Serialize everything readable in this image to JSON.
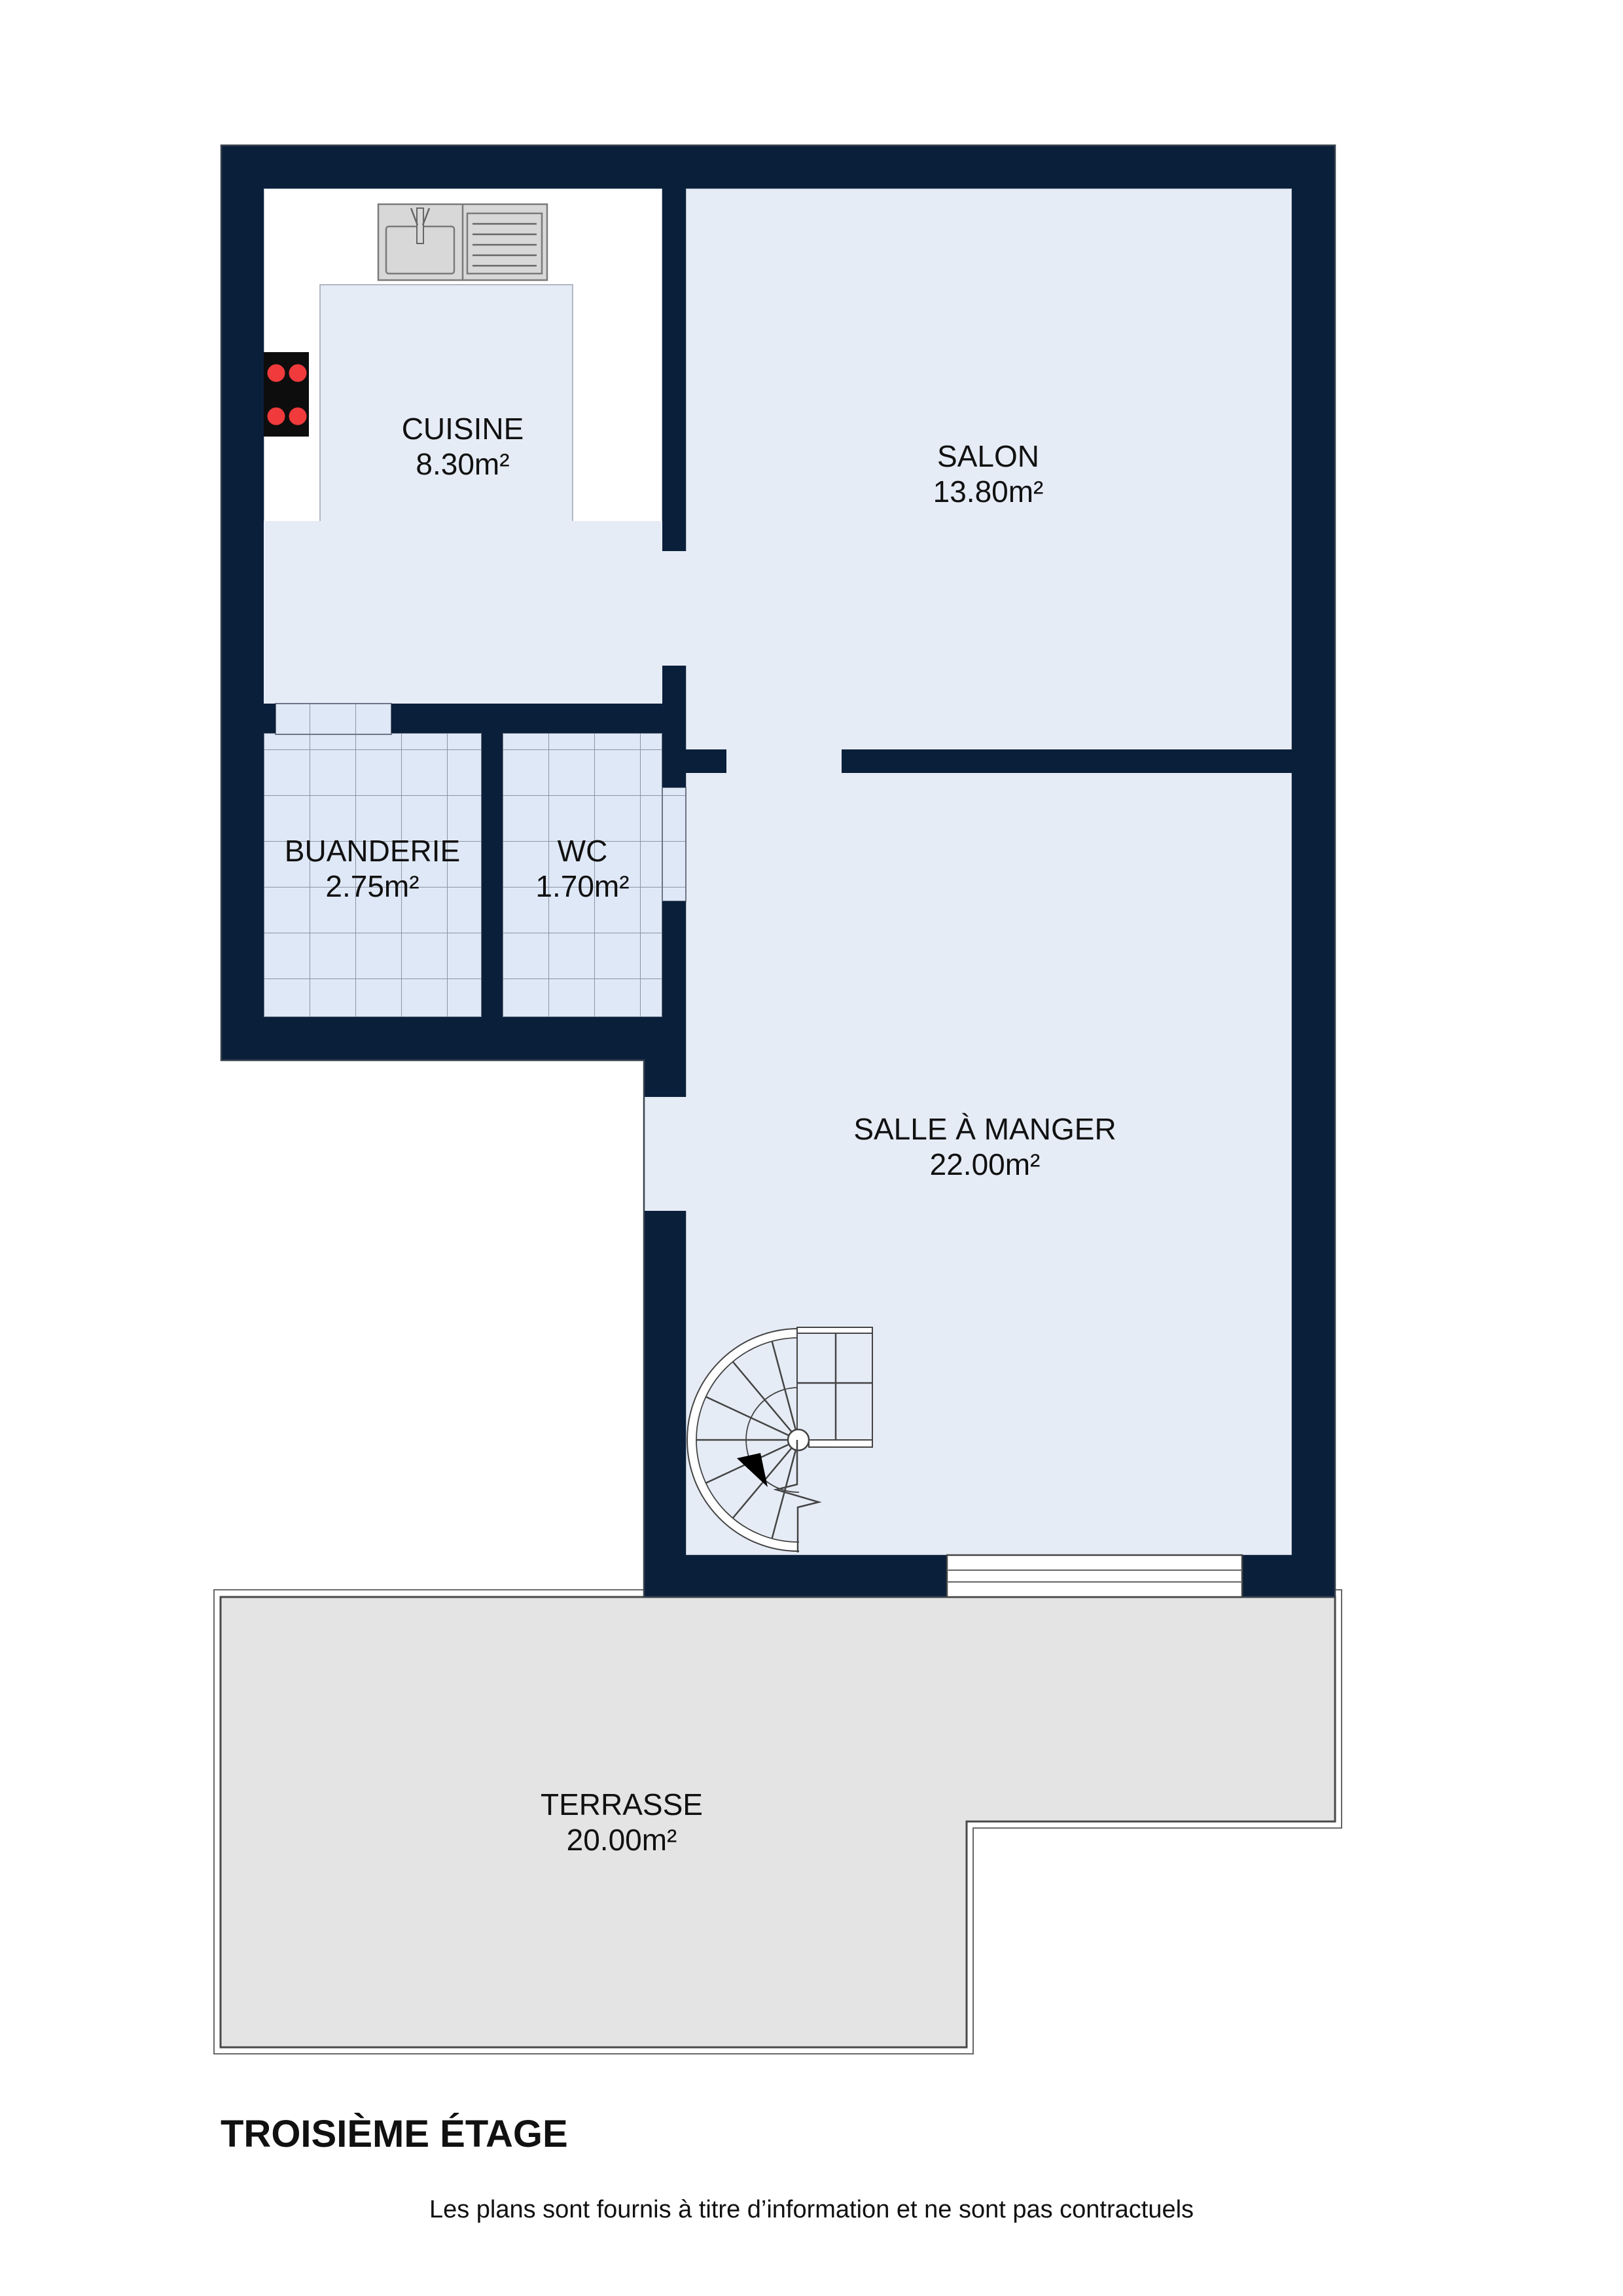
{
  "plan": {
    "title": "TROISIÈME ÉTAGE",
    "disclaimer": "Les plans sont fournis à titre d’information et ne sont pas contractuels",
    "rooms": {
      "cuisine": {
        "name": "CUISINE",
        "area": "8.30m²"
      },
      "salon": {
        "name": "SALON",
        "area": "13.80m²"
      },
      "buanderie": {
        "name": "BUANDERIE",
        "area": "2.75m²"
      },
      "wc": {
        "name": "WC",
        "area": "1.70m²"
      },
      "salle_a_manger": {
        "name": "SALLE À MANGER",
        "area": "22.00m²"
      },
      "terrasse": {
        "name": "TERRASSE",
        "area": "20.00m²"
      }
    },
    "icons": {
      "sink": "kitchen-sink-with-drainer",
      "stove": "four-burner-stove",
      "stairs": "spiral-staircase"
    },
    "colors": {
      "wall": "#0a1f3a",
      "wallLine": "#39424f",
      "floor": "#e6ecf6",
      "floorLine": "#9aa3b2",
      "tile": "#dfe8f6",
      "tileLine": "#8b94a3",
      "tileEdge": "#6d7686",
      "kitchenWhite": "#ffffff",
      "terrace": "#e4e4e4",
      "terraceBorder": "#4a4a4a",
      "terraceOutline": "#555555",
      "counter": "#d8d8d8",
      "counterBorder": "#7a7a7a",
      "counterLine": "#666666",
      "stove": "#0d0d0d",
      "burner": "#f03a3c",
      "windowLine": "#444444",
      "stairLine": "#444444",
      "text": "#111111"
    }
  }
}
